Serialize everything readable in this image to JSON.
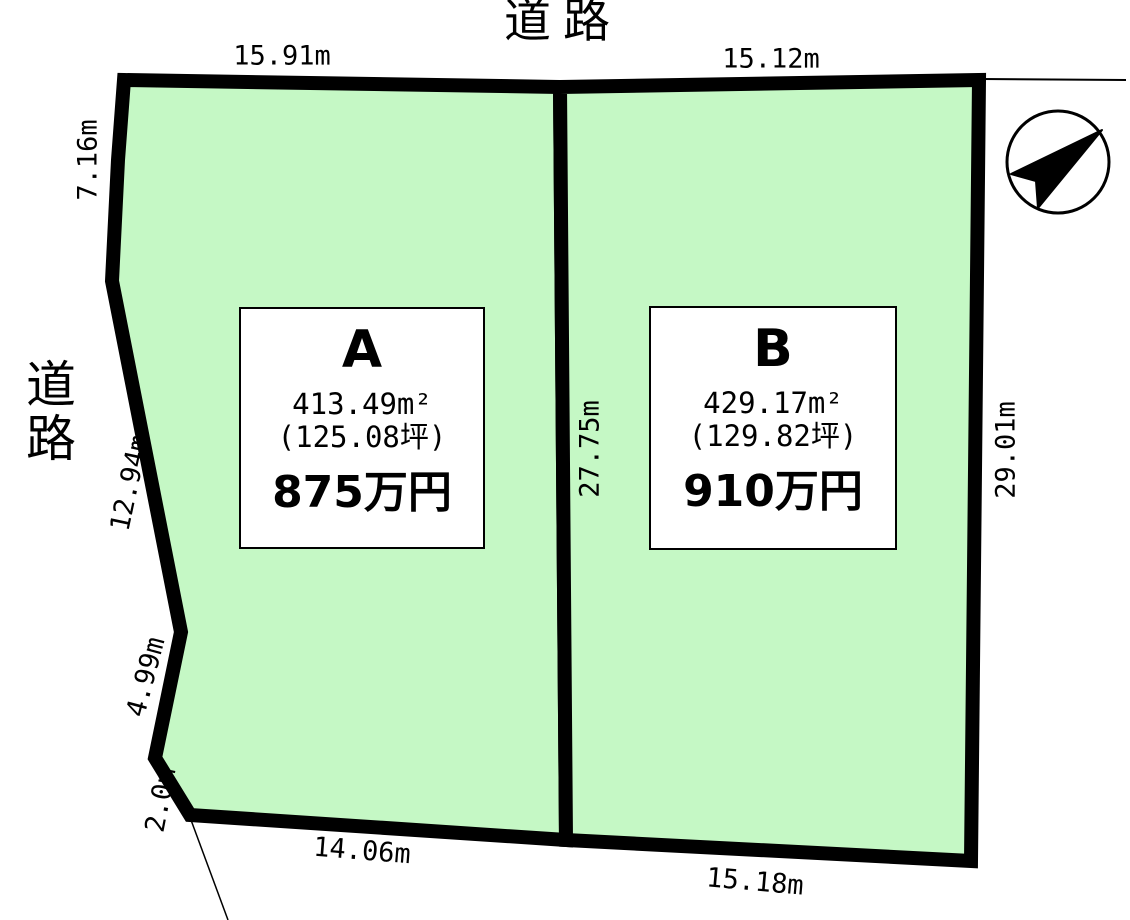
{
  "diagram": {
    "type": "land-plot-layout",
    "road_label_top": "道路",
    "road_label_left": "道路",
    "north_arrow_direction": "northeast"
  },
  "colors": {
    "parcel_fill": "#c5f8c5",
    "outline": "#000000",
    "info_box_bg": "#ffffff"
  },
  "parcels": [
    {
      "id": "A",
      "area_m2": "413.49m²",
      "area_tsubo": "(125.08坪)",
      "price": "875万円"
    },
    {
      "id": "B",
      "area_m2": "429.17m²",
      "area_tsubo": "(129.82坪)",
      "price": "910万円"
    }
  ],
  "dimensions": {
    "top_a": "15.91m",
    "top_b": "15.12m",
    "left_upper": "7.16m",
    "left_middle": "12.94m",
    "left_lower": "4.99m",
    "left_bottom": "2.0m",
    "bottom_a": "14.06m",
    "bottom_b": "15.18m",
    "center_divider": "27.75m",
    "right_side": "29.01m"
  }
}
